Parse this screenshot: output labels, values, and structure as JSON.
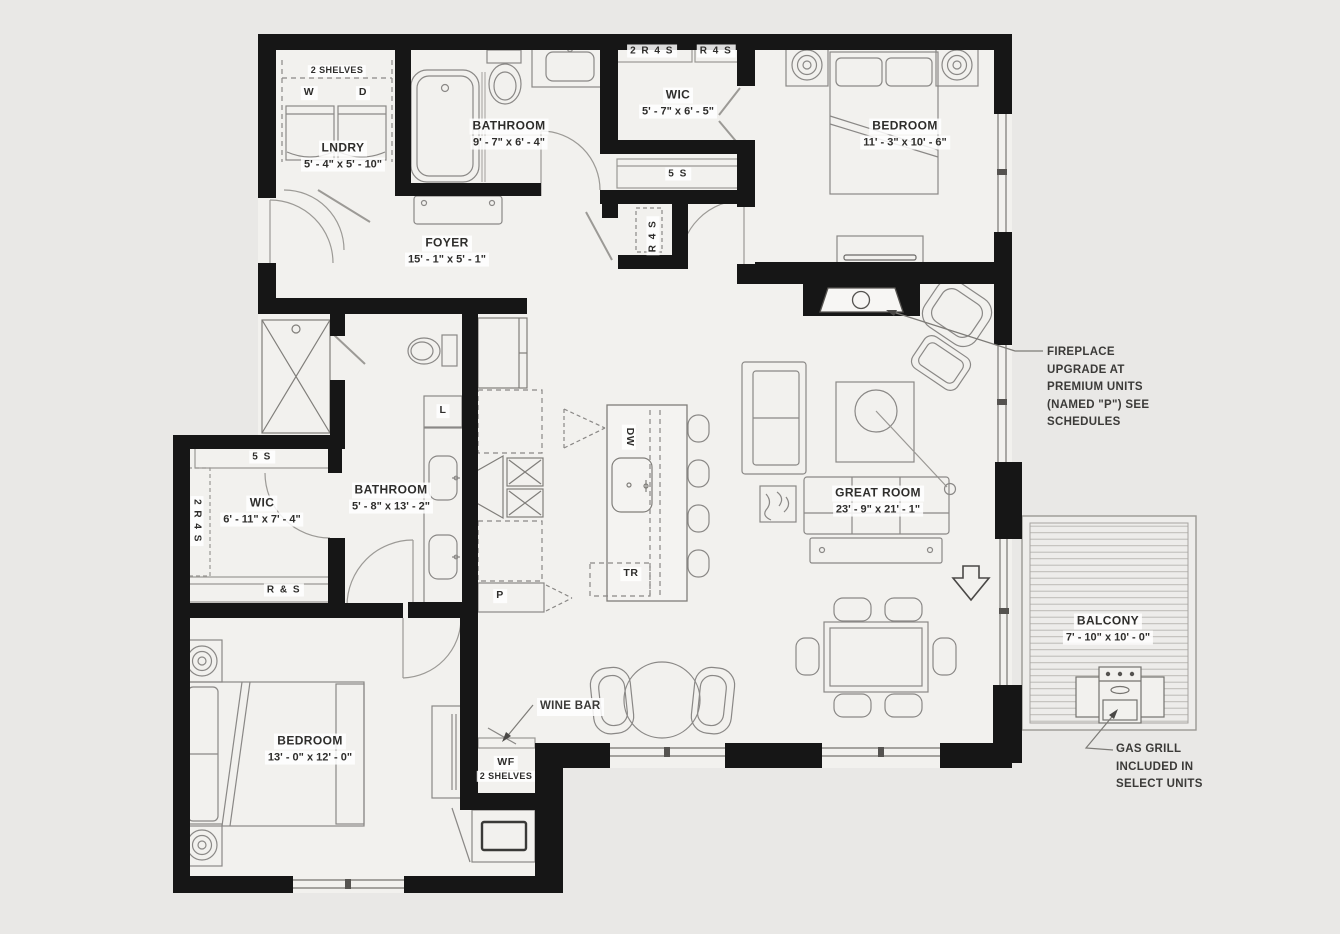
{
  "meta": {
    "background": "#e9e8e6",
    "floor": "#f2f1ee",
    "wall": "#161616",
    "furniture_line": "#8a8886",
    "deck_line": "#bcbab6"
  },
  "rooms": {
    "laundry": {
      "name": "LNDRY",
      "dims": "5' - 4\" x 5' - 10\"",
      "shelves": "2 SHELVES",
      "washer": "W",
      "dryer": "D"
    },
    "bathroom1": {
      "name": "BATHROOM",
      "dims": "9' - 7\" x 6' - 4\""
    },
    "wic1": {
      "name": "WIC",
      "dims": "5' - 7\" x 6' - 5\"",
      "shelf_left": "2 R 4 S",
      "shelf_right": "R 4 S",
      "shelf_below": "5 S"
    },
    "hall_closet": {
      "shelf": "R 4 S"
    },
    "bedroom1": {
      "name": "BEDROOM",
      "dims": "11' - 3\" x 10' - 6\""
    },
    "foyer": {
      "name": "FOYER",
      "dims": "15' - 1\" x 5' - 1\""
    },
    "bathroom2": {
      "name": "BATHROOM",
      "dims": "5' - 8\" x 13' - 2\"",
      "linen": "L"
    },
    "wic2": {
      "name": "WIC",
      "dims": "6' - 11\" x 7' - 4\"",
      "shelf_top": "5 S",
      "shelf_bottom": "R & S",
      "shelf_left": "2 R 4 S"
    },
    "kitchen": {
      "dishwasher": "DW",
      "trash": "TR",
      "pantry": "P"
    },
    "great_room": {
      "name": "GREAT ROOM",
      "dims": "23' - 9\" x 21' - 1\""
    },
    "bedroom2": {
      "name": "BEDROOM",
      "dims": "13' - 0\" x 12' - 0\""
    },
    "wine_closet": {
      "name": "WF",
      "shelves": "2 SHELVES"
    },
    "balcony": {
      "name": "BALCONY",
      "dims": "7' - 10\" x 10' - 0\""
    }
  },
  "annotations": {
    "fireplace": "FIREPLACE\nUPGRADE AT\nPREMIUM UNITS\n(NAMED \"P\") SEE\nSCHEDULES",
    "wine_bar": "WINE BAR",
    "gas_grill": "GAS GRILL\nINCLUDED IN\nSELECT UNITS"
  },
  "icons": [
    "washer",
    "dryer",
    "bathtub",
    "toilet",
    "sink-vanity",
    "shower",
    "closet-shelf",
    "bed",
    "nightstand-lamp",
    "dresser",
    "tv-console",
    "fireplace",
    "armchair",
    "ottoman",
    "sofa",
    "loveseat",
    "coffee-table",
    "floor-lamp",
    "console-table",
    "dining-table",
    "dining-chair",
    "cafe-table",
    "bar-stool",
    "kitchen-island",
    "island-sink",
    "refrigerator",
    "range-cooktop",
    "range-hood",
    "pantry-cabinet",
    "wine-fridge",
    "gas-grill",
    "balcony-deck",
    "door-swing",
    "window",
    "entry-arrow"
  ]
}
